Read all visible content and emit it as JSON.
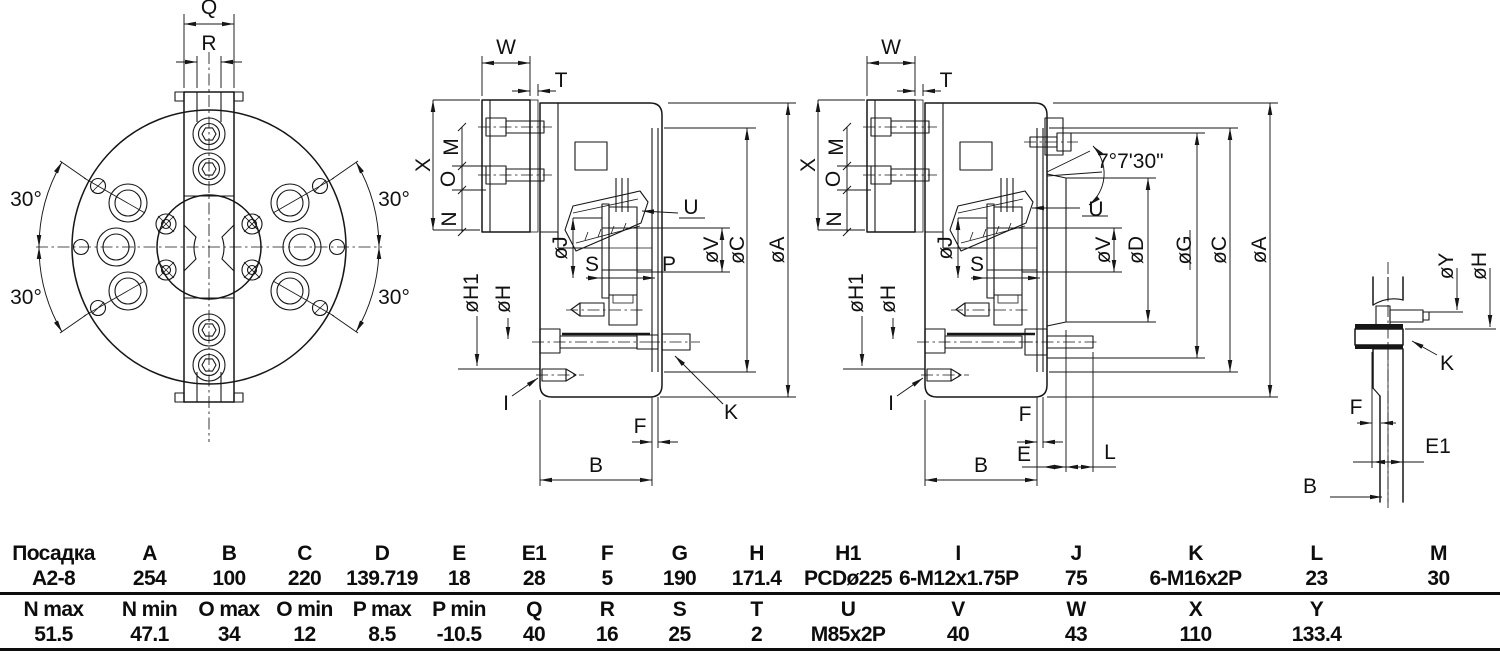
{
  "front_view": {
    "q": "Q",
    "r": "R",
    "angle_tl": "30°",
    "angle_bl": "30°",
    "angle_tr": "30°",
    "angle_br": "30°"
  },
  "section_a": {
    "w": "W",
    "t": "T",
    "x": "X",
    "m": "M",
    "o": "O",
    "n": "N",
    "h1": "øH1",
    "h": "øH",
    "j": "øJ",
    "s": "S",
    "p": "P",
    "u": "U",
    "v": "øV",
    "c": "øC",
    "a": "øA",
    "i": "I",
    "k": "K",
    "f": "F",
    "b": "B"
  },
  "section_b": {
    "w": "W",
    "t": "T",
    "x": "X",
    "m": "M",
    "o": "O",
    "n": "N",
    "h1": "øH1",
    "h": "øH",
    "j": "øJ",
    "s": "S",
    "u": "U",
    "angle": "7°7'30\"",
    "v": "øV",
    "d": "øD",
    "g": "øG",
    "c": "øC",
    "a": "øA",
    "i": "I",
    "f": "F",
    "e": "E",
    "l": "L",
    "b": "B"
  },
  "detail_view": {
    "y": "øY",
    "h": "øH",
    "k": "K",
    "f": "F",
    "e1": "E1",
    "b": "B"
  },
  "table": {
    "r1h": [
      "Посадка",
      "A",
      "B",
      "C",
      "D",
      "E",
      "E1",
      "F",
      "G",
      "H",
      "H1",
      "I",
      "J",
      "K",
      "L",
      "M"
    ],
    "r1v": [
      "A2-8",
      "254",
      "100",
      "220",
      "139.719",
      "18",
      "28",
      "5",
      "190",
      "171.4",
      "PCDø225",
      "6-M12x1.75P",
      "75",
      "6-M16x2P",
      "23",
      "30"
    ],
    "r2h": [
      "N max",
      "N min",
      "O max",
      "O min",
      "P max",
      "P min",
      "Q",
      "R",
      "S",
      "T",
      "U",
      "V",
      "W",
      "X",
      "Y",
      ""
    ],
    "r2v": [
      "51.5",
      "47.1",
      "34",
      "12",
      "8.5",
      "-10.5",
      "40",
      "16",
      "25",
      "2",
      "M85x2P",
      "40",
      "43",
      "110",
      "133.4",
      ""
    ]
  }
}
